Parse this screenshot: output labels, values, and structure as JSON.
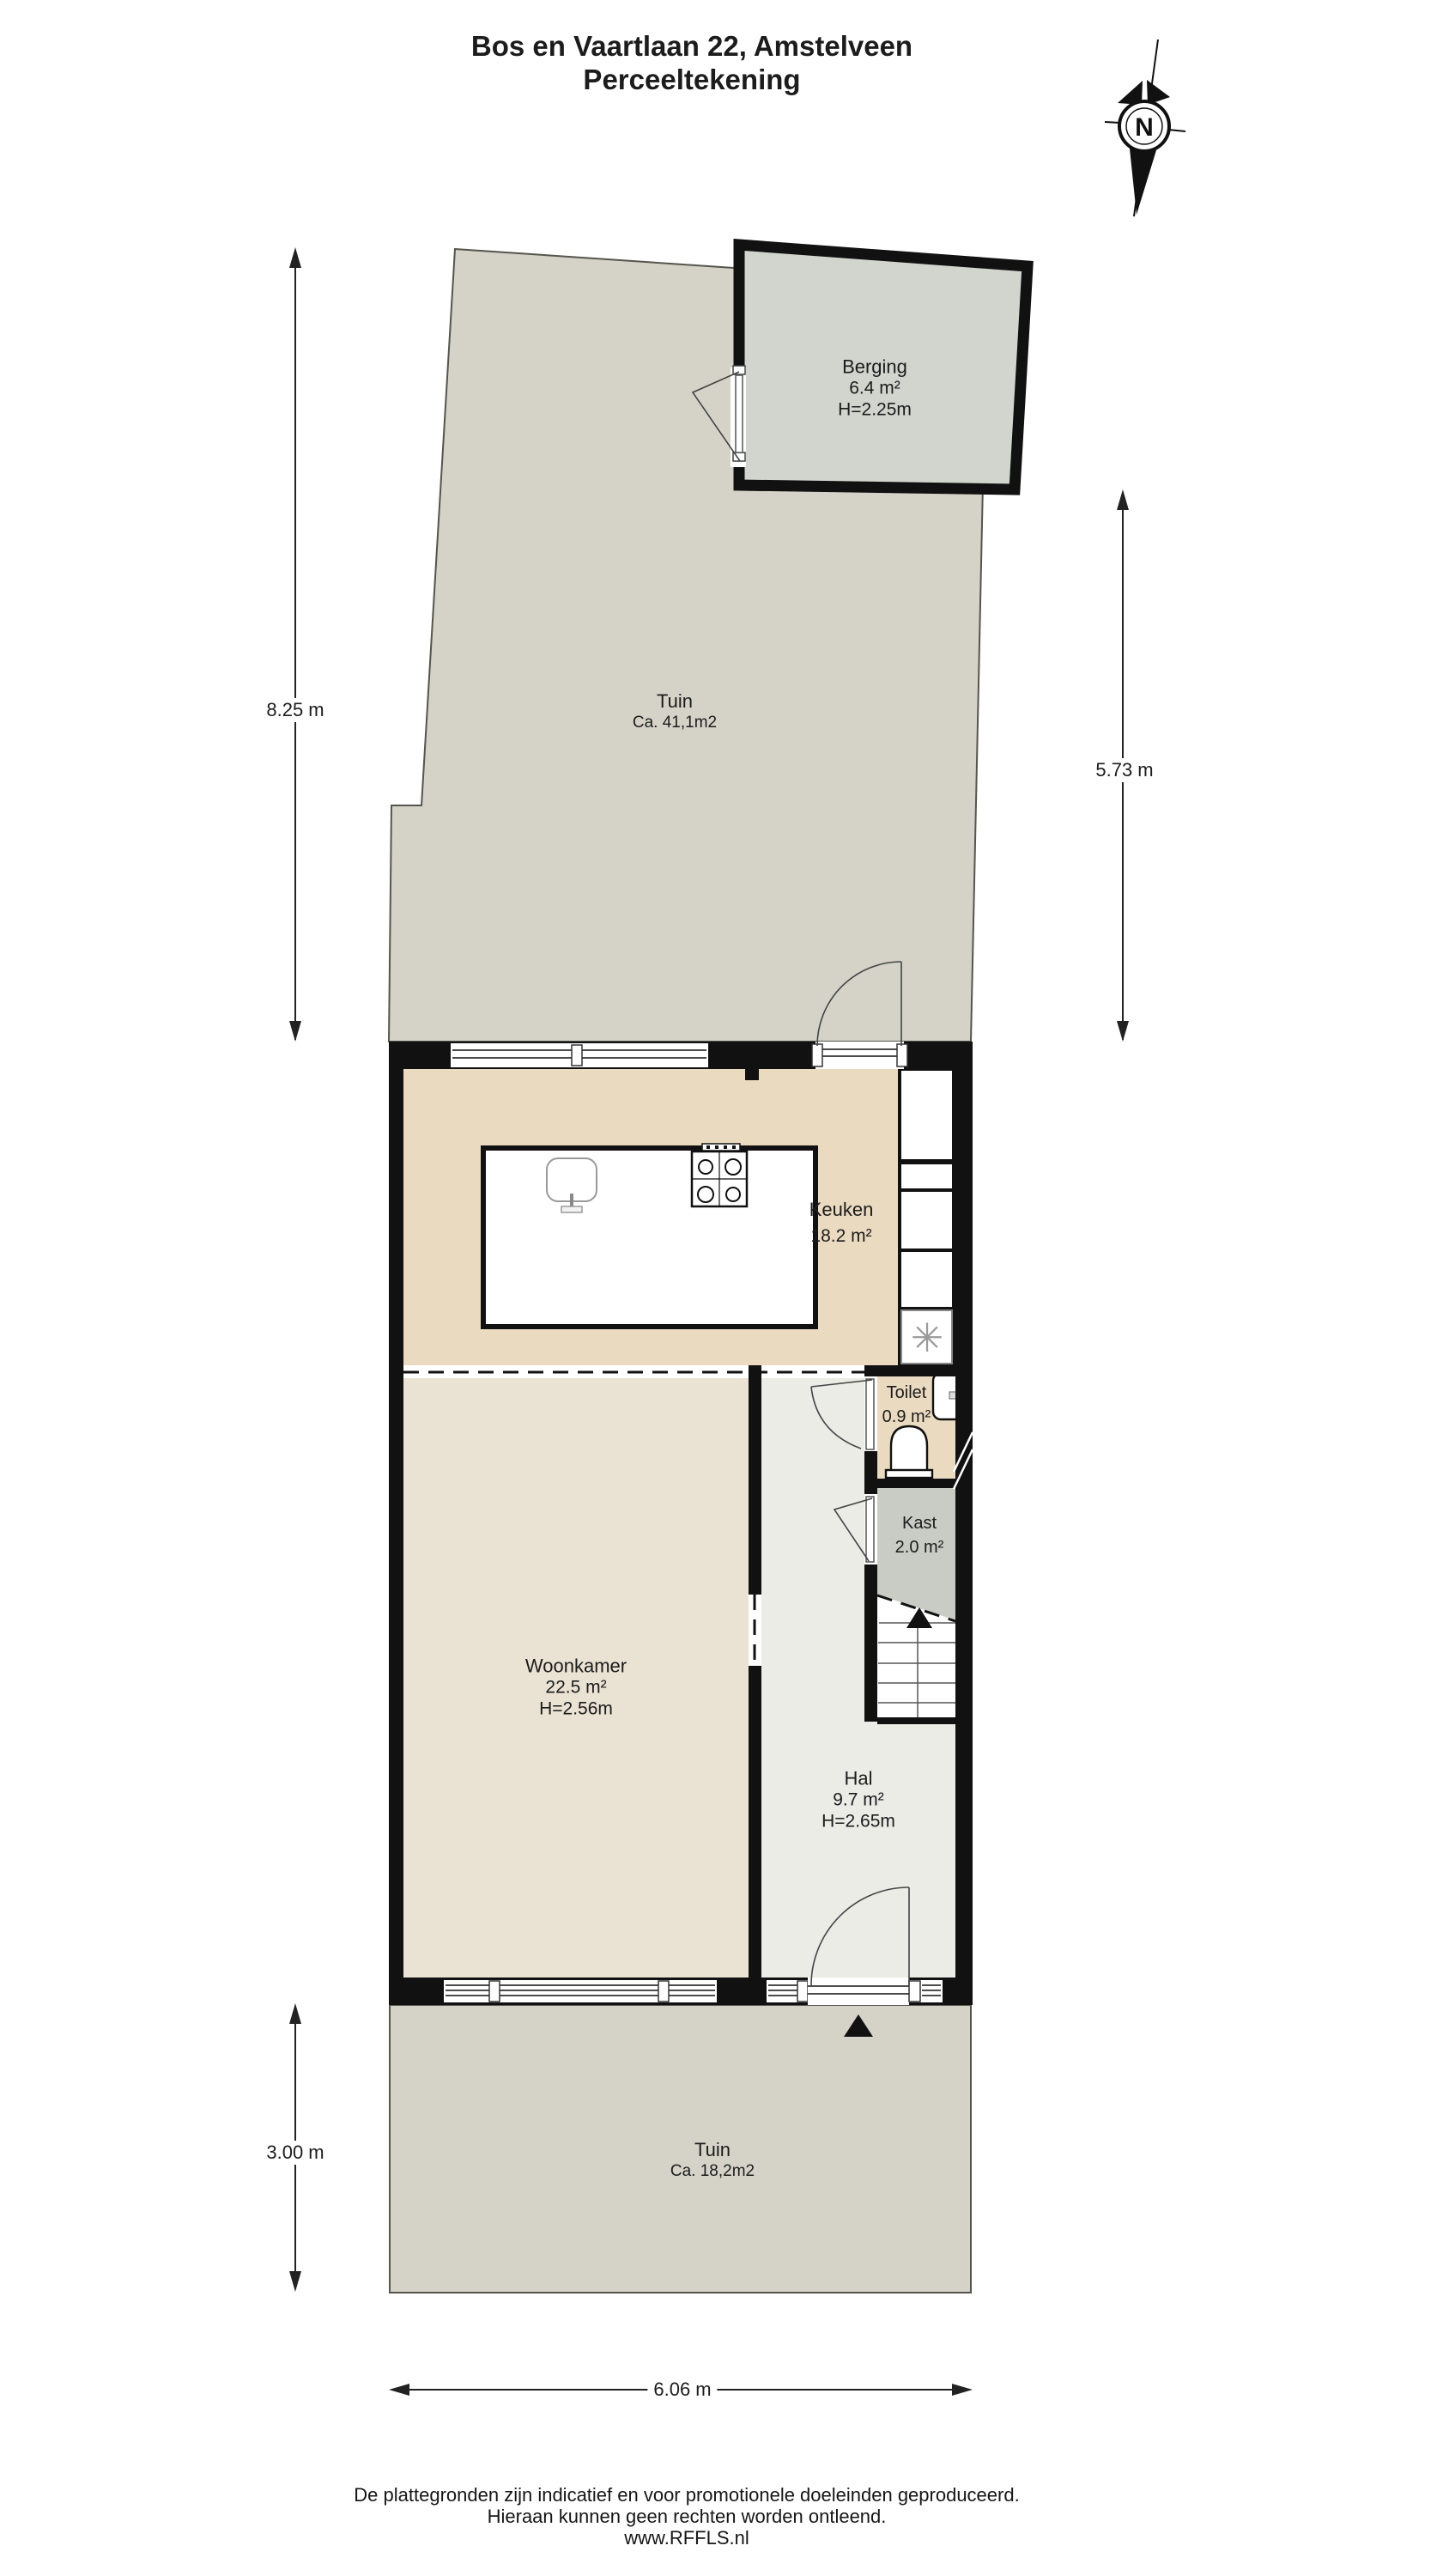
{
  "title": {
    "line1": "Bos en Vaartlaan 22, Amstelveen",
    "line2": "Perceeltekening"
  },
  "compass": {
    "label": "N"
  },
  "rooms": {
    "tuin_top": {
      "name": "Tuin",
      "area": "Ca. 41,1m2"
    },
    "berging": {
      "name": "Berging",
      "area": "6.4 m²",
      "height": "H=2.25m"
    },
    "keuken": {
      "name": "Keuken",
      "area": "18.2 m²"
    },
    "toilet": {
      "name": "Toilet",
      "area": "0.9 m²"
    },
    "kast": {
      "name": "Kast",
      "area": "2.0 m²"
    },
    "woonkamer": {
      "name": "Woonkamer",
      "area": "22.5 m²",
      "height": "H=2.56m"
    },
    "hal": {
      "name": "Hal",
      "area": "9.7 m²",
      "height": "H=2.65m"
    },
    "tuin_bottom": {
      "name": "Tuin",
      "area": "Ca. 18,2m2"
    }
  },
  "dimensions": {
    "garden_top_left": "8.25 m",
    "garden_top_right": "5.73 m",
    "garden_bottom_left": "3.00 m",
    "house_width_bottom": "6.06 m"
  },
  "icons": {
    "freezer_snowflake": "✳"
  },
  "footer": {
    "line1": "De plattegronden zijn indicatief en voor promotionele doeleinden geproduceerd.",
    "line2": "Hieraan kunnen geen rechten worden ontleend.",
    "line3": "www.RFFLS.nl"
  },
  "colors": {
    "wall": "#111111",
    "garden": "#d5d3c8",
    "berging_floor": "#d2d5ce",
    "keuken_floor": "#eadac0",
    "woonkamer_floor": "#eae2d3",
    "hal_floor": "#ecece6",
    "kast_floor": "#c9ccc5",
    "stairs": "#ffffff",
    "edge": "#55554d"
  }
}
